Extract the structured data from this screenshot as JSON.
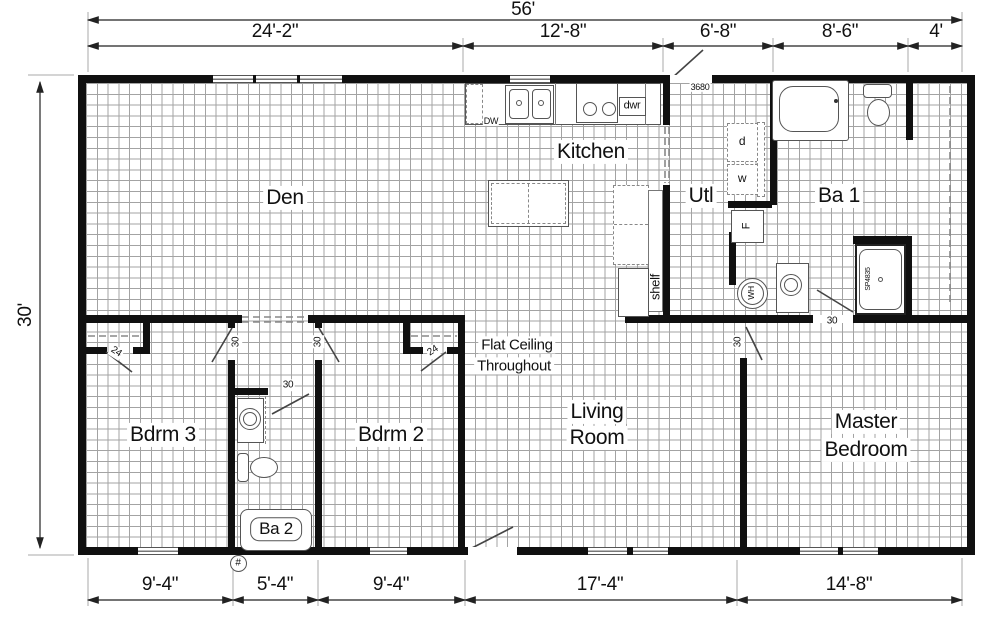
{
  "dims": {
    "total_width": "56'",
    "total_height": "30'",
    "top": [
      "24'-2\"",
      "12'-8\"",
      "6'-8\"",
      "8'-6\"",
      "4'"
    ],
    "bottom": [
      "9'-4\"",
      "5'-4\"",
      "9'-4\"",
      "17'-4\"",
      "14'-8\""
    ]
  },
  "rooms": {
    "den": "Den",
    "kitchen": "Kitchen",
    "utl": "Utl",
    "ba1": "Ba 1",
    "bdrm3": "Bdrm 3",
    "bdrm2": "Bdrm 2",
    "ba2": "Ba 2",
    "living_line1": "Living",
    "living_line2": "Room",
    "master_line1": "Master",
    "master_line2": "Bedroom"
  },
  "notes": {
    "ceiling_line1": "Flat Ceiling",
    "ceiling_line2": "Throughout"
  },
  "fixtures": {
    "dishwasher": "DW",
    "drawer": "dwr",
    "shelf": "shelf",
    "dryer": "d",
    "washer": "w",
    "furnace": "F",
    "water_heater": "WH",
    "shower_model": "SP4835",
    "door_tag": "3680",
    "hash_mark": "#"
  },
  "door_sizes": {
    "d30": "30",
    "d24": "24"
  },
  "colors": {
    "wall": "#101010",
    "grid": "#a3a3a3",
    "background": "#ffffff"
  }
}
